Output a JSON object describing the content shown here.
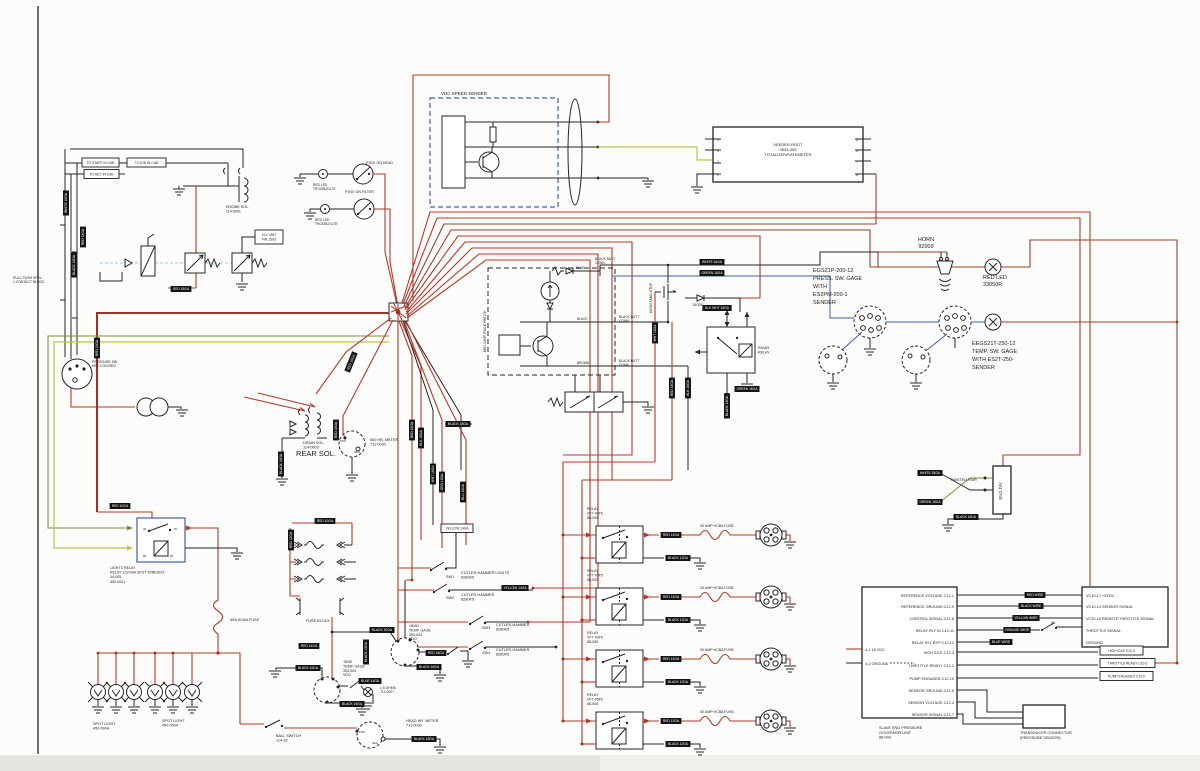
{
  "meta": {
    "title": "Engine / pump wiring schematic (scanned)"
  },
  "colors": {
    "wire_red": "#b5372b",
    "wire_brown": "#9a4030",
    "wire_black": "#242424",
    "wire_blue": "#3f5fa0",
    "wire_green": "#7a8f3c",
    "wire_yellow": "#bcc24d",
    "tag_bg": "#141414",
    "tag_text": "#ffffff"
  },
  "text_labels": [
    {
      "n": "vdc-speed-sender-label",
      "x": 441,
      "y": 95,
      "t": "VDC SPEED SENDER",
      "s": 4.5
    },
    {
      "n": "veeder-root-label",
      "x": 788,
      "y": 146,
      "t": "VEEDER-ROOT\n0633-305\nTOTALIZER/RATEMETER",
      "s": 4,
      "lh": 5,
      "a": "middle"
    },
    {
      "n": "horn-label",
      "x": 926,
      "y": 241,
      "t": "HORN\n92909",
      "s": 5.5,
      "lh": 7,
      "a": "middle"
    },
    {
      "n": "red-led-label",
      "x": 983,
      "y": 279,
      "t": "RED LED\n33050R",
      "s": 5.5,
      "lh": 7
    },
    {
      "n": "press-gage-label",
      "x": 813,
      "y": 272,
      "t": "EGS21P-200-12\nPRESS. SW. GAGE\nWITH\nES2PM-200-1\nSENDER",
      "s": 5.5,
      "lh": 8
    },
    {
      "n": "temp-gage-label",
      "x": 972,
      "y": 345,
      "t": "EEGS21T-250-12\nTEMP. SW. GAGE\nWITH ES2T-250-\nSENDER",
      "s": 5.5,
      "lh": 8
    },
    {
      "n": "rear-sol-label",
      "x": 296,
      "y": 456,
      "t": "REAR SOL.",
      "s": 7.5
    },
    {
      "n": "drain-sol-label",
      "x": 303,
      "y": 444,
      "t": "DRAIN SOL.\n114-0003",
      "s": 3.8,
      "lh": 4.5
    },
    {
      "n": "hr-meter-500-label",
      "x": 370,
      "y": 441,
      "t": "500 HR. METER\n711-0030",
      "s": 3.8,
      "lh": 4.5
    },
    {
      "n": "lights-relay-label",
      "x": 110,
      "y": 569,
      "t": "LIGHTS RELAY\nRELAY 12V/30A SPST W/RESIST.\n44-005\n450-0001",
      "s": 3.6,
      "lh": 4.6
    },
    {
      "n": "fuse-40a-label",
      "x": 230,
      "y": 621,
      "t": "40A HCBA FUSE",
      "s": 3.8
    },
    {
      "n": "fuse-block-label",
      "x": 306,
      "y": 622,
      "t": "FUSE BLOCK",
      "s": 3.8
    },
    {
      "n": "spot-light-label-1",
      "x": 93,
      "y": 725,
      "t": "SPOT LIGHT.\n450-0004",
      "s": 3.8,
      "lh": 4.5
    },
    {
      "n": "spot-light-label-2",
      "x": 162,
      "y": 722,
      "t": "SPOT LIGHT.\n450-0004",
      "s": 3.8,
      "lh": 4.5
    },
    {
      "n": "ball-switch-label",
      "x": 276,
      "y": 737,
      "t": "BALL SWITCH\n114-18",
      "s": 3.8,
      "lh": 4.5
    },
    {
      "n": "tank-temp-gage-label",
      "x": 343,
      "y": 663,
      "t": "TANK\nTEMP. GAGE\n300-004\nVDO",
      "s": 3.6,
      "lh": 4.4
    },
    {
      "n": "head-temp-gage-label",
      "x": 409,
      "y": 627,
      "t": "HEAD\nTEMP. GAGE\n300-004\nVDO",
      "s": 3.6,
      "lh": 4.4
    },
    {
      "n": "head-hr-meter-label",
      "x": 406,
      "y": 722,
      "t": "HEAD HR. METER\n711-0030",
      "s": 3.8,
      "lh": 4.5
    },
    {
      "n": "resistor-label",
      "x": 380,
      "y": 689,
      "t": "1.5 OHMS\n711-0007",
      "s": 3.4,
      "lh": 4.2
    },
    {
      "n": "sw1-label",
      "x": 446,
      "y": 578,
      "t": "SW1",
      "s": 3.8
    },
    {
      "n": "cutler-switch-label",
      "x": 461,
      "y": 574,
      "t": "CUTLER-HAMMER LIGHTS\n8280K5",
      "s": 3.8,
      "lh": 4.6
    },
    {
      "n": "sw2-label",
      "x": 446,
      "y": 599,
      "t": "SW2",
      "s": 3.8
    },
    {
      "n": "cutler-switch-label",
      "x": 461,
      "y": 596,
      "t": "CUTLER-HAMMER\n8280K5",
      "s": 3.8,
      "lh": 4.6
    },
    {
      "n": "sw3-label",
      "x": 482,
      "y": 629,
      "t": "SW3",
      "s": 3.8
    },
    {
      "n": "cutler-switch-label",
      "x": 496,
      "y": 626,
      "t": "CUTLER-HAMMER\n8280K5",
      "s": 3.8,
      "lh": 4.6
    },
    {
      "n": "sw4-label",
      "x": 482,
      "y": 654,
      "t": "SW4",
      "s": 3.8
    },
    {
      "n": "cutler-switch-label",
      "x": 496,
      "y": 651,
      "t": "CUTLER-HAMMER\n8280K5",
      "s": 3.8,
      "lh": 4.6
    },
    {
      "n": "relay-label",
      "x": 587,
      "y": 510,
      "t": "RELAY\nVF7 45F5\n88-005",
      "s": 3.6,
      "lh": 4.4
    },
    {
      "n": "relay-label",
      "x": 587,
      "y": 572,
      "t": "RELAY\nVF7 45F5\n88-005",
      "s": 3.6,
      "lh": 4.4
    },
    {
      "n": "relay-label",
      "x": 587,
      "y": 634,
      "t": "RELAY\nVF7 45F5\n88-005",
      "s": 3.6,
      "lh": 4.4
    },
    {
      "n": "relay-label",
      "x": 587,
      "y": 696,
      "t": "RELAY\nVF7 45F5\n88-005",
      "s": 3.6,
      "lh": 4.4
    },
    {
      "n": "fuse-30a-label",
      "x": 700,
      "y": 527,
      "t": "30 AMP HCBA FUSE",
      "s": 3.6
    },
    {
      "n": "fuse-30a-label",
      "x": 700,
      "y": 589,
      "t": "30 AMP HCBA FUSE",
      "s": 3.6
    },
    {
      "n": "fuse-30a-label",
      "x": 700,
      "y": 651,
      "t": "30 AMP HCBA FUSE",
      "s": 3.6
    },
    {
      "n": "fuse-30a-label",
      "x": 700,
      "y": 713,
      "t": "30 AMP HCBA FUSE",
      "s": 3.6
    },
    {
      "n": "twisted-pair-label",
      "x": 950,
      "y": 481,
      "t": "TWISTED PAIR",
      "s": 3.8
    },
    {
      "n": "governor-unit-label",
      "x": 879,
      "y": 729,
      "t": "SLAVE ENG PRESSURE\nGOVERNOR UNIT\n88-044",
      "s": 3.8,
      "lh": 4.8
    },
    {
      "n": "transducer-label",
      "x": 1020,
      "y": 734,
      "t": "TRANSDUCER CONNECTOR\n(PRESSURE SENSOR)",
      "s": 3.8,
      "lh": 4.8
    },
    {
      "n": "gov-pin-label",
      "x": 954,
      "y": 597,
      "t": "REFERENCE VOLTAGE C12-1",
      "s": 3.8,
      "a": "end"
    },
    {
      "n": "gov-pin-label",
      "x": 954,
      "y": 608,
      "t": "REFERENCE GROUND C12-9",
      "s": 3.8,
      "a": "end"
    },
    {
      "n": "gov-pin-label",
      "x": 954,
      "y": 620,
      "t": "CONTROL SIGNAL C12-8",
      "s": 3.8,
      "a": "end"
    },
    {
      "n": "gov-pin-label",
      "x": 954,
      "y": 632,
      "t": "RELAY RLY IN C12-11",
      "s": 3.8,
      "a": "end"
    },
    {
      "n": "gov-pin-label",
      "x": 954,
      "y": 644,
      "t": "RELAY RLY BYP C12-12",
      "s": 3.8,
      "a": "end"
    },
    {
      "n": "gov-pin-label",
      "x": 954,
      "y": 654,
      "t": "HIGH IDLE C12-3",
      "s": 3.8,
      "a": "end"
    },
    {
      "n": "gov-pin-label",
      "x": 954,
      "y": 667,
      "t": "THROTTLE READY C12-2",
      "s": 3.8,
      "a": "end"
    },
    {
      "n": "gov-pin-label",
      "x": 954,
      "y": 680,
      "t": "PUMP ENGAGED C12-10",
      "s": 3.8,
      "a": "end"
    },
    {
      "n": "gov-pin-label",
      "x": 954,
      "y": 692,
      "t": "SENSOR GROUND C12-5",
      "s": 3.8,
      "a": "end"
    },
    {
      "n": "gov-pin-label",
      "x": 954,
      "y": 704,
      "t": "SENSOR VOLTAGE C12-4",
      "s": 3.8,
      "a": "end"
    },
    {
      "n": "gov-pin-label",
      "x": 954,
      "y": 716,
      "t": "SENSOR SIGNAL C12-7",
      "s": 3.8,
      "a": "end"
    },
    {
      "n": "vc10-pin-label",
      "x": 1086,
      "y": 597,
      "t": "VC10-17 +5VDC",
      "s": 3.8
    },
    {
      "n": "vc10-pin-label",
      "x": 1086,
      "y": 608,
      "t": "VC10-14 SENSOR SIGNAL",
      "s": 3.8
    },
    {
      "n": "vc10-pin-label",
      "x": 1086,
      "y": 620,
      "t": "VC10-18 REMOTE THROTTLE SIGNAL",
      "s": 3.8
    },
    {
      "n": "vc10-pin-label",
      "x": 1086,
      "y": 632,
      "t": "THROTTLE SIGNAL",
      "s": 3.8
    },
    {
      "n": "vc10-pin-label",
      "x": 1086,
      "y": 644,
      "t": "GROUND",
      "s": 3.8
    },
    {
      "n": "vdc-supply-label",
      "x": 865,
      "y": 651,
      "t": "4-1 18 VDC",
      "s": 3.8
    },
    {
      "n": "ground-ref-label",
      "x": 865,
      "y": 665,
      "t": "4-2 GROUND",
      "s": 3.8
    },
    {
      "n": "pack-patch-label",
      "x": 486,
      "y": 352,
      "t": "MID-SHIP PACK PATCH",
      "s": 3.8,
      "rot": -90
    },
    {
      "n": "kickstand-label",
      "x": 652,
      "y": 313,
      "t": "KICKSTAND STOP",
      "s": 3.5,
      "rot": -90
    },
    {
      "n": "psw-head-label",
      "x": 366,
      "y": 164,
      "t": "P.SW. ON HEAD",
      "s": 3.6
    },
    {
      "n": "psw-filter-label",
      "x": 345,
      "y": 193,
      "t": "P.SW. ON FILTER",
      "s": 3.6
    },
    {
      "n": "troublelite-label",
      "x": 313,
      "y": 186,
      "t": "RED LED\nTROUBLELITE",
      "s": 3.3,
      "lh": 4
    },
    {
      "n": "troublelite-label",
      "x": 315,
      "y": 221,
      "t": "RED LED\nTROUBLELITE",
      "s": 3.3,
      "lh": 4
    },
    {
      "n": "engine-sol-label",
      "x": 226,
      "y": 208,
      "t": "ENGINE SOL.\n114-0001",
      "s": 3.6,
      "lh": 4.4
    },
    {
      "n": "contact-block-label",
      "x": 13,
      "y": 279,
      "t": "PULL-PUSH SPDL\n1 CONTACT BLOCK",
      "s": 3.4,
      "lh": 4.2
    },
    {
      "n": "pressure-sw-label",
      "x": 92,
      "y": 363,
      "t": "PRESSURE SW\nKEY # ON REG",
      "s": 3.4,
      "lh": 4.2
    },
    {
      "n": "eng-div-label",
      "x": 1002,
      "y": 491,
      "t": "ENG DIV",
      "s": 4.2,
      "rot": -90,
      "a": "middle"
    },
    {
      "n": "switch-5v-label",
      "x": 1051,
      "y": 624,
      "t": "5V",
      "s": 3.6
    },
    {
      "n": "butt-conn-label",
      "x": 595,
      "y": 260,
      "t": "BLACK BUTT\nCONN.",
      "s": 3.3,
      "lh": 4
    },
    {
      "n": "butt-conn-label",
      "x": 619,
      "y": 318,
      "t": "BLACK BUTT\nCONN.",
      "s": 3.3,
      "lh": 4
    },
    {
      "n": "butt-conn-label",
      "x": 619,
      "y": 362,
      "t": "BLACK BUTT\nCONN.",
      "s": 3.3,
      "lh": 4
    },
    {
      "n": "blue-wire-note",
      "x": 576,
      "y": 269,
      "t": "BLUE",
      "s": 3.2
    },
    {
      "n": "black-wire-note",
      "x": 577,
      "y": 320,
      "t": "BLACK",
      "s": 3.2
    },
    {
      "n": "brown-wire-note",
      "x": 577,
      "y": 364,
      "t": "BROWN",
      "s": 3.2
    },
    {
      "n": "center-relay-label",
      "x": 758,
      "y": 349,
      "t": "RA/AN\nRELAY",
      "s": 3.6,
      "lh": 4.4
    },
    {
      "n": "diode-label",
      "x": 693,
      "y": 306,
      "t": "DIODE",
      "s": 3.2
    },
    {
      "n": "veeder-pin-label",
      "x": 717,
      "y": 141,
      "t": "4",
      "s": 3.2
    },
    {
      "n": "veeder-pin-label",
      "x": 717,
      "y": 152,
      "t": "3",
      "s": 3.2
    },
    {
      "n": "veeder-pin-label",
      "x": 717,
      "y": 163,
      "t": "2",
      "s": 3.2
    },
    {
      "n": "veeder-pin-label",
      "x": 717,
      "y": 176,
      "t": "1",
      "s": 3.2
    },
    {
      "n": "veeder-pin-label",
      "x": 858,
      "y": 141,
      "t": "5",
      "s": 3.2,
      "a": "end"
    },
    {
      "n": "veeder-pin-label",
      "x": 858,
      "y": 152,
      "t": "6",
      "s": 3.2,
      "a": "end"
    },
    {
      "n": "veeder-pin-label",
      "x": 858,
      "y": 163,
      "t": "7",
      "s": 3.2,
      "a": "end"
    },
    {
      "n": "veeder-pin-label",
      "x": 858,
      "y": 176,
      "t": "8",
      "s": 3.2,
      "a": "end"
    },
    {
      "n": "meter-pos-label",
      "x": 340,
      "y": 442,
      "t": "POS",
      "s": 2.8
    },
    {
      "n": "meter-neg-label",
      "x": 354,
      "y": 453,
      "t": "NEG",
      "s": 2.8
    },
    {
      "n": "meter-pos-label",
      "x": 359,
      "y": 733,
      "t": "POS",
      "s": 2.8
    },
    {
      "n": "meter-neg-label",
      "x": 372,
      "y": 744,
      "t": "NEG",
      "s": 2.8
    },
    {
      "n": "relay-pin-label",
      "x": 143,
      "y": 530,
      "t": "30",
      "s": 2.8
    },
    {
      "n": "relay-pin-label",
      "x": 174,
      "y": 530,
      "t": "87",
      "s": 2.8
    },
    {
      "n": "relay-pin-label",
      "x": 143,
      "y": 557,
      "t": "85",
      "s": 2.8
    },
    {
      "n": "relay-pin-label",
      "x": 170,
      "y": 557,
      "t": "86",
      "s": 2.8
    }
  ],
  "wire_tags": [
    {
      "x": 66,
      "y": 203,
      "t": "WHITE 18GA",
      "r": -90
    },
    {
      "x": 74,
      "y": 265,
      "t": "BLACK 18GA",
      "r": -90
    },
    {
      "x": 83,
      "y": 237,
      "t": "RED 18GA",
      "r": -90
    },
    {
      "x": 181,
      "y": 289,
      "t": "RED 18GA"
    },
    {
      "x": 97,
      "y": 348,
      "t": "RED 10GA",
      "r": -90
    },
    {
      "x": 351,
      "y": 362,
      "t": "RED 10GA",
      "r": -68
    },
    {
      "x": 281,
      "y": 464,
      "t": "BLACK 16GA",
      "r": -90
    },
    {
      "x": 336,
      "y": 430,
      "t": "RED 18GA",
      "r": -90
    },
    {
      "x": 412,
      "y": 430,
      "t": "RED 18GA",
      "r": -90
    },
    {
      "x": 421,
      "y": 438,
      "t": "BLK 18GA",
      "r": -90
    },
    {
      "x": 433,
      "y": 474,
      "t": "WHT 18GA",
      "r": -90
    },
    {
      "x": 442,
      "y": 482,
      "t": "GRN 18GA",
      "r": -90
    },
    {
      "x": 458,
      "y": 424,
      "t": "BLACK 18GA"
    },
    {
      "x": 463,
      "y": 492,
      "t": "BLU 18GA",
      "r": -90
    },
    {
      "x": 712,
      "y": 262,
      "t": "WHITE 16GA"
    },
    {
      "x": 712,
      "y": 273,
      "t": "GREEN 16GA"
    },
    {
      "x": 717,
      "y": 308,
      "t": "BLK WHT 16GA"
    },
    {
      "x": 747,
      "y": 389,
      "t": "GREEN 16GA"
    },
    {
      "x": 655,
      "y": 333,
      "t": "WHT 18GA",
      "r": -90
    },
    {
      "x": 672,
      "y": 388,
      "t": "RED 18GA",
      "r": -90
    },
    {
      "x": 688,
      "y": 388,
      "t": "BLK 18GA",
      "r": -90
    },
    {
      "x": 727,
      "y": 406,
      "t": "BLACK 12GA",
      "r": -90
    },
    {
      "x": 120,
      "y": 506,
      "t": "RED 10GA"
    },
    {
      "x": 325,
      "y": 521,
      "t": "RED 10GA"
    },
    {
      "x": 291,
      "y": 540,
      "t": "RED 12GA",
      "r": -90
    },
    {
      "x": 309,
      "y": 646,
      "t": "RED 14GA"
    },
    {
      "x": 308,
      "y": 668,
      "t": "BLACK 16GA"
    },
    {
      "x": 382,
      "y": 630,
      "t": "BLACK 20GA"
    },
    {
      "x": 436,
      "y": 653,
      "t": "RED 18GA"
    },
    {
      "x": 429,
      "y": 667,
      "t": "BLACK 16GA"
    },
    {
      "x": 370,
      "y": 681,
      "t": "BLUE 14GA"
    },
    {
      "x": 352,
      "y": 704,
      "t": "BLACK 16GA"
    },
    {
      "x": 366,
      "y": 652,
      "t": "BLACK 18GA",
      "r": -90
    },
    {
      "x": 424,
      "y": 739,
      "t": "BLACK 18GA"
    },
    {
      "x": 515,
      "y": 588,
      "t": "YELLOW 14GA"
    },
    {
      "x": 671,
      "y": 535,
      "t": "RED 12GA"
    },
    {
      "x": 678,
      "y": 558,
      "t": "BLACK 12GA"
    },
    {
      "x": 671,
      "y": 597,
      "t": "RED 12GA"
    },
    {
      "x": 678,
      "y": 620,
      "t": "BLACK 12GA"
    },
    {
      "x": 671,
      "y": 659,
      "t": "RED 12GA"
    },
    {
      "x": 678,
      "y": 682,
      "t": "BLACK 12GA"
    },
    {
      "x": 671,
      "y": 721,
      "t": "RED 12GA"
    },
    {
      "x": 678,
      "y": 744,
      "t": "BLACK 12GA"
    },
    {
      "x": 930,
      "y": 473,
      "t": "WHITE 18GA"
    },
    {
      "x": 930,
      "y": 502,
      "t": "GREEN 18GA"
    },
    {
      "x": 966,
      "y": 517,
      "t": "BLACK 18GA"
    },
    {
      "x": 1035,
      "y": 595,
      "t": "RED WIRE"
    },
    {
      "x": 1031,
      "y": 606,
      "t": "BLACK WIRE"
    },
    {
      "x": 1026,
      "y": 618,
      "t": "YELLOW WIRE"
    },
    {
      "x": 1017,
      "y": 630,
      "t": "ORANGE WIRE"
    },
    {
      "x": 1001,
      "y": 642,
      "t": "BLUE WIRE"
    }
  ],
  "boxed_labels": [
    {
      "n": "to-start-label",
      "x": 82,
      "y": 158,
      "w": 37,
      "h": 9,
      "t": "TO START IN CAB"
    },
    {
      "n": "to-acc-label",
      "x": 84,
      "y": 169.5,
      "w": 35,
      "h": 9,
      "t": "TO ACC IN CAB"
    },
    {
      "n": "to-ign-label",
      "x": 127,
      "y": 158,
      "w": 39,
      "h": 9,
      "t": "TO IGN IN CAB"
    },
    {
      "n": "vlv-unit-label",
      "x": 255,
      "y": 230,
      "w": 28,
      "h": 14,
      "t": "VLV UNIT\nPIN 15/16"
    },
    {
      "n": "yellow-14ga-label",
      "x": 441,
      "y": 524,
      "w": 32,
      "h": 8.5,
      "t": "YELLOW 14GA"
    },
    {
      "n": "high-idle-c10-label",
      "x": 1100,
      "y": 646,
      "w": 43,
      "h": 9,
      "t": "HIGH IDLE C10-3"
    },
    {
      "n": "throttle-ready-c10-label",
      "x": 1100,
      "y": 658.5,
      "w": 55,
      "h": 9,
      "t": "THROTTLE READY C10-2"
    },
    {
      "n": "pump-engaged-c10-label",
      "x": 1100,
      "y": 671.5,
      "w": 53,
      "h": 9,
      "t": "PUMP ENGAGED C10-5"
    }
  ]
}
